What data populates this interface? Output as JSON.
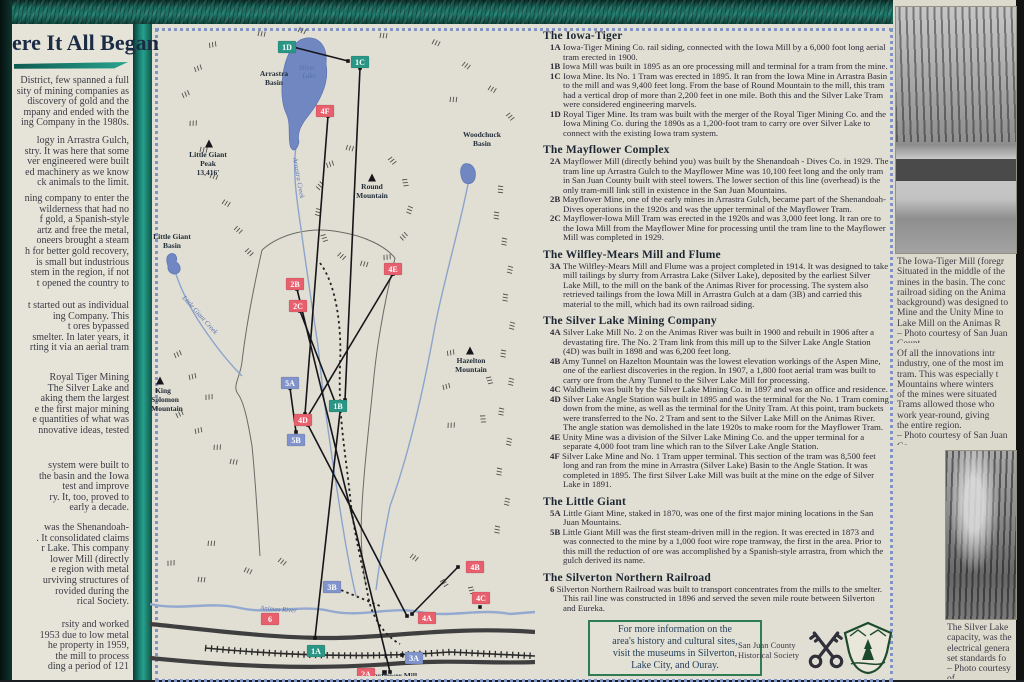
{
  "sign": {
    "title": "ere It All Began",
    "left_paragraphs": [
      "District, few spanned a full\nsity of mining companies as\ndiscovery of gold and the\nmpany and ended with the\ning Company in the 1980s.",
      "logy in Arrastra Gulch,\nstry. It was here that some\nver engineered were built\ned machinery as we know\nck animals to the limit.",
      "ning company to enter the\nwilderness that had no\nf gold, a Spanish-style\nartz and free the metal,\noneers brought a steam\nh for better gold recovery,\nis small but industrious\nstem in the region, if not\nt opened the country to",
      "t started out as individual\ning Company. This\nt ores bypassed\nsmelter. In later years, it\nrting it via an aerial tram",
      "Royal Tiger Mining\nThe Silver Lake and\naking them the largest\ne the first major mining\ne quantities of what was\nnnovative ideas, tested",
      "system were built to\nthe basin and the Iowa\ntest and improve\nry. It, too, proved to\nearly a decade.",
      "was the Shenandoah-\n. It consolidated claims\nr Lake. This company\nlower Mill (directly\ne region with metal\nurviving structures of\nrovided during the\nrical Society.",
      "rsity and worked\n1953 due to low metal\nhe property in 1959,\nthe mill to process\nding a period of 121"
    ]
  },
  "sections": [
    {
      "title": "The Iowa-Tiger",
      "items": [
        {
          "label": "1A",
          "text": "Iowa-Tiger Mining Co. rail siding, connected with the Iowa Mill by a 6,000 foot long aerial tram erected in 1900."
        },
        {
          "label": "1B",
          "text": "Iowa Mill was built in 1895 as an ore processing mill and terminal for a tram from the mine."
        },
        {
          "label": "1C",
          "text": "Iowa Mine. Its No. 1 Tram was erected in 1895. It ran from the Iowa Mine in Arrastra Basin to the mill and was 9,400 feet long. From the base of Round Mountain to the mill, this tram had a vertical drop of more than 2,200 feet in one mile. Both this and the Silver Lake Tram were considered engineering marvels."
        },
        {
          "label": "1D",
          "text": "Royal Tiger Mine. Its tram was built with the merger of the Royal Tiger Mining Co. and the Iowa Mining Co. during the 1890s as a 1,200-foot tram to carry ore over Silver Lake to connect with the existing Iowa tram system."
        }
      ]
    },
    {
      "title": "The Mayflower Complex",
      "items": [
        {
          "label": "2A",
          "text": "Mayflower Mill (directly behind you) was built by the Shenandoah - Dives Co. in 1929. The tram line up Arrastra Gulch to the Mayflower Mine was 10,100 feet long and the only tram in San Juan County built with steel towers. The lower section of this line (overhead) is the only tram-mill link still in existence in the San Juan Mountains."
        },
        {
          "label": "2B",
          "text": "Mayflower Mine, one of the early mines in Arrastra Gulch, became part of the Shenandoah-Dives operations in the 1920s and was the upper terminal of the Mayflower Tram."
        },
        {
          "label": "2C",
          "text": "Mayflower-Iowa Mill Tram was erected in the 1920s and was 3,000 feet long. It ran ore to the Iowa Mill from the Mayflower Mine for processing until the tram line to the Mayflower Mill was completed in 1929."
        }
      ]
    },
    {
      "title": "The Wilfley-Mears Mill and Flume",
      "items": [
        {
          "label": "3A",
          "text": "The Wilfley-Mears Mill and Flume was a project completed in 1914. It was designed to take mill tailings by slurry from Arrastra Lake (Silver Lake), deposited by the earliest Silver Lake Mill, to the mill on the bank of the Animas River for processing. The system also retrieved tailings from the Iowa Mill in Arrastra Gulch at a dam (3B) and carried this material to the mill, which had its own railroad siding."
        }
      ]
    },
    {
      "title": "The Silver Lake Mining Company",
      "items": [
        {
          "label": "4A",
          "text": "Silver Lake Mill No. 2 on the Animas River was built in 1900 and rebuilt in 1906 after a devastating fire. The No. 2 Tram link from this mill up to the Silver Lake Angle Station (4D) was built in 1898 and was 6,200 feet long."
        },
        {
          "label": "4B",
          "text": "Amy Tunnel on Hazelton Mountain was the lowest elevation workings of the Aspen Mine, one of the earliest discoveries in the region. In 1907, a 1,800 foot aerial tram was built to carry ore from the Amy Tunnel to the Silver Lake Mill for processing."
        },
        {
          "label": "4C",
          "text": "Waldheim was built by the Silver Lake Mining Co. in 1897 and was an office and residence."
        },
        {
          "label": "4D",
          "text": "Silver Lake Angle Station was built in 1895 and was the terminal for the No. 1 Tram coming down from the mine, as well as the terminal for the Unity Tram. At this point, tram buckets were transferred to the No. 2 Tram and sent to the Silver Lake Mill on the Animas River. The angle station was demolished in the late 1920s to make room for the Mayflower Tram."
        },
        {
          "label": "4E",
          "text": "Unity Mine was a division of the Silver Lake Mining Co. and the upper terminal for a separate 4,000 foot tram line which ran to the Silver Lake Angle Station."
        },
        {
          "label": "4F",
          "text": "Silver Lake Mine and No. 1 Tram upper terminal. This section of the tram was 8,500 feet long and ran from the mine in Arrastra (Silver Lake) Basin to the Angle Station. It was completed in 1895. The first Silver Lake Mill was built at the mine on the edge of Silver Lake in 1891."
        }
      ]
    },
    {
      "title": "The Little Giant",
      "items": [
        {
          "label": "5A",
          "text": "Little Giant Mine, staked in 1870, was one of the first major mining locations in the San Juan Mountains."
        },
        {
          "label": "5B",
          "text": "Little Giant Mill was the first steam-driven mill in the region. It was erected in 1873 and was connected to the mine by a 1,000 foot wire rope tramway, the first in the area. Prior to this mill the reduction of ore was accomplished by a Spanish-style arrastra, from which the gulch derived its name."
        }
      ]
    },
    {
      "title": "The Silverton Northern Railroad",
      "items": [
        {
          "label": "6",
          "text": "Silverton Northern Railroad was built to transport concentrates from the mills to the smelter. This rail line was constructed in 1896 and served the seven mile route between Silverton and Eureka."
        }
      ]
    }
  ],
  "map": {
    "markers": [
      {
        "label": "1D",
        "group": "teal"
      },
      {
        "label": "1C",
        "group": "teal"
      },
      {
        "label": "4F",
        "group": "red"
      },
      {
        "label": "2B",
        "group": "red"
      },
      {
        "label": "2C",
        "group": "red"
      },
      {
        "label": "4E",
        "group": "red"
      },
      {
        "label": "5A",
        "group": "blue"
      },
      {
        "label": "1B",
        "group": "teal"
      },
      {
        "label": "4D",
        "group": "red"
      },
      {
        "label": "5B",
        "group": "blue"
      },
      {
        "label": "3B",
        "group": "blue"
      },
      {
        "label": "6",
        "group": "red"
      },
      {
        "label": "1A",
        "group": "teal"
      },
      {
        "label": "2A",
        "group": "red"
      },
      {
        "label": "3A",
        "group": "blue"
      },
      {
        "label": "4A",
        "group": "red"
      },
      {
        "label": "4B",
        "group": "red"
      },
      {
        "label": "4C",
        "group": "red"
      }
    ],
    "labels": {
      "arrastra_basin": [
        "Arrastra",
        "Basin"
      ],
      "silver_lake": [
        "Silver",
        "Lake"
      ],
      "woodchuck_basin": [
        "Woodchuck",
        "Basin"
      ],
      "little_giant_peak": [
        "Little Giant",
        "Peak",
        "13,416'"
      ],
      "round_mountain": [
        "Round",
        "Mountain"
      ],
      "little_giant_basin": [
        "Little Giant",
        "Basin"
      ],
      "hazelton_mountain": [
        "Hazelton",
        "Mountain"
      ],
      "king_solomon_mountain": [
        "King",
        "Solomon",
        "Mountain"
      ],
      "arrastra_creek": "Arrastra Creek",
      "little_giant_creek": "Little Giant Creek",
      "animas_river": "Animas River",
      "mayflower_mill": "Mayflower Mill"
    }
  },
  "info_box": {
    "text": "For more information on the\narea's history and cultural sites,\nvisit the museums in Silverton,\nLake City, and Ouray."
  },
  "credits": {
    "society": "San Juan County\nHistorical Society"
  },
  "right_column": {
    "caption1": "The Iowa-Tiger Mill (foregr\nSituated in the middle of the\nmines in the basin. The conc\nrailroad siding on the Anima\nbackground) was designed to\nMine and the Unity Mine to\nLake Mill on the Animas R\n– Photo courtesy of San Juan Count",
    "paragraph": "Of all the innovations intr\nindustry, one of the most im\ntram. This was especially t\nMountains where winters\nof the mines were situated\nTrams allowed those who\nwork year-round, giving\nthe entire region.\n– Photo courtesy of San Juan Co",
    "caption2": "The Silver Lake\ncapacity, was the\nelectrical genera\nset standards fo\n– Photo courtesy of"
  },
  "colors": {
    "panel_cream": "#e1dfd3",
    "frame_teal": "#1c7f70",
    "marker_teal": "#2a9685",
    "marker_red": "#e8606e",
    "marker_blue": "#8093cb",
    "lake_blue": "#7187c1",
    "info_box_green": "#2f7d52"
  }
}
